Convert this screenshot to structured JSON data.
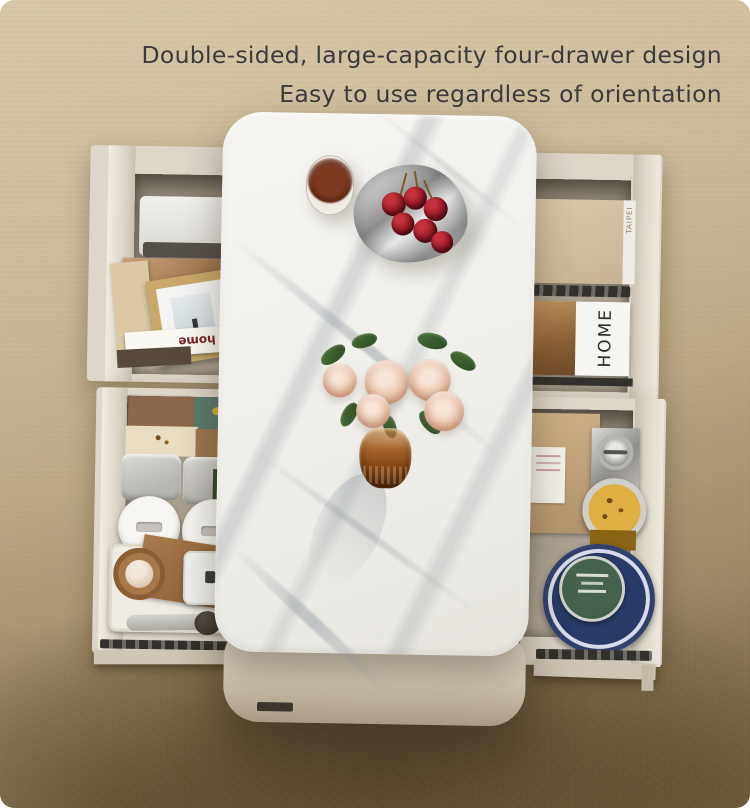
{
  "headline": {
    "line1": "Double-sided, large-capacity four-drawer design",
    "line2": "Easy to use regardless of orientation",
    "color": "#3b3b3b"
  },
  "drawer_items": {
    "home_magazine_title": "HOME",
    "at_home_book_title": "at home",
    "taipei_book_spine": "TAIPEI"
  },
  "palette": {
    "carpet_light": "#cdbc9b",
    "carpet_shadow": "#6b5840",
    "marble_top": "#f3f2ef",
    "table_body": "#cfc4b2",
    "drawer_shell": "#ddd6c9",
    "cherry_red": "#8e1722",
    "rose_pink": "#eecdb8",
    "vase_amber": "#a8652c",
    "headline_text": "#3b3b3b"
  }
}
